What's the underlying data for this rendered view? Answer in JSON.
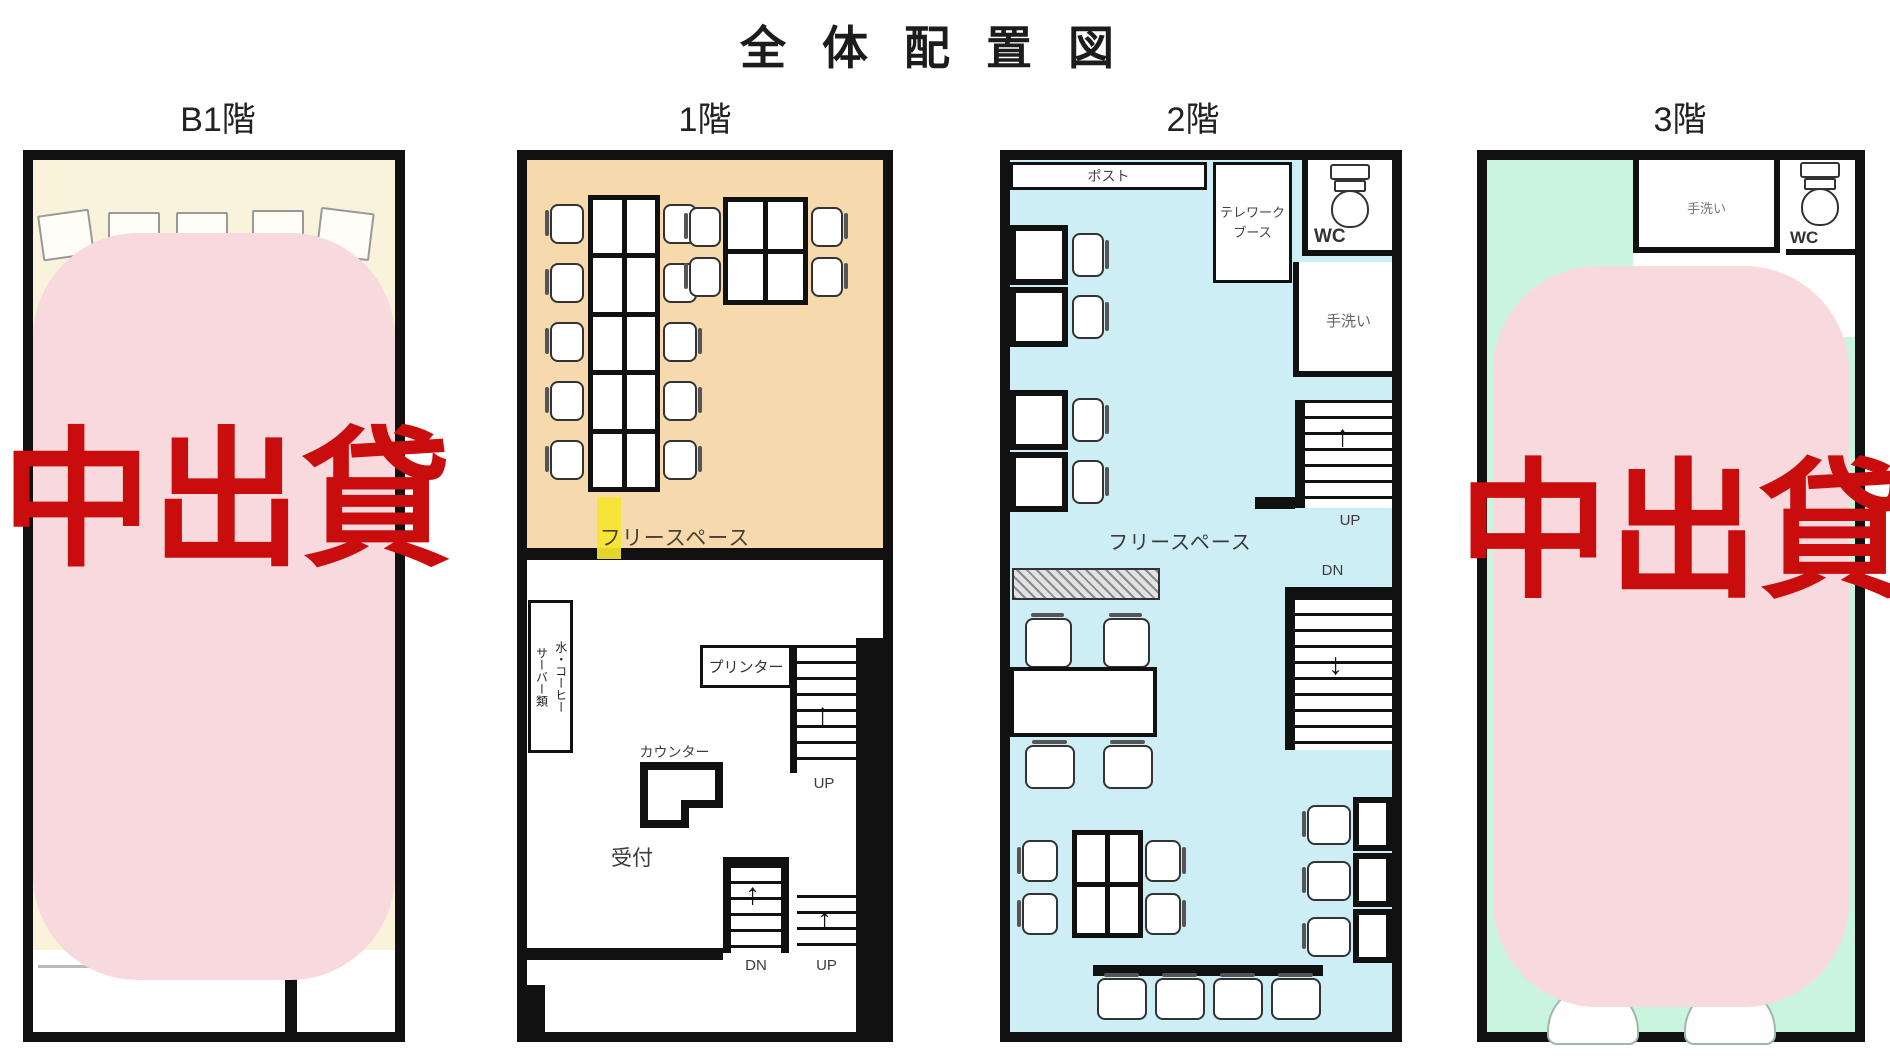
{
  "title": "全体配置図",
  "colors": {
    "badge_bg": "#f8d9dd",
    "badge_text": "#c90d0d",
    "b1_floor": "#f8f3da",
    "f1_freespace": "#f6d9ac",
    "f2_floor": "#cdeef5",
    "f3_floor": "#c9f4de",
    "highlight_yellow": "#f6e52e",
    "wall": "#111111"
  },
  "floors": {
    "b1": {
      "label": "B1階",
      "badge": "貸出中"
    },
    "f1": {
      "label": "1階",
      "freespace": "フリースペース",
      "server": "水・コーヒー\nサーバー類",
      "printer": "プリンター",
      "counter": "カウンター",
      "reception": "受付",
      "stairs_up": "UP",
      "stairs_dn": "DN"
    },
    "f2": {
      "label": "2階",
      "post": "ポスト",
      "telework": "テレワーク\nブース",
      "wc": "WC",
      "handwash": "手洗い",
      "freespace": "フリースペース",
      "stairs_up": "UP",
      "stairs_dn": "DN"
    },
    "f3": {
      "label": "3階",
      "handwash": "手洗い",
      "wc": "WC",
      "badge": "貸出中"
    }
  }
}
